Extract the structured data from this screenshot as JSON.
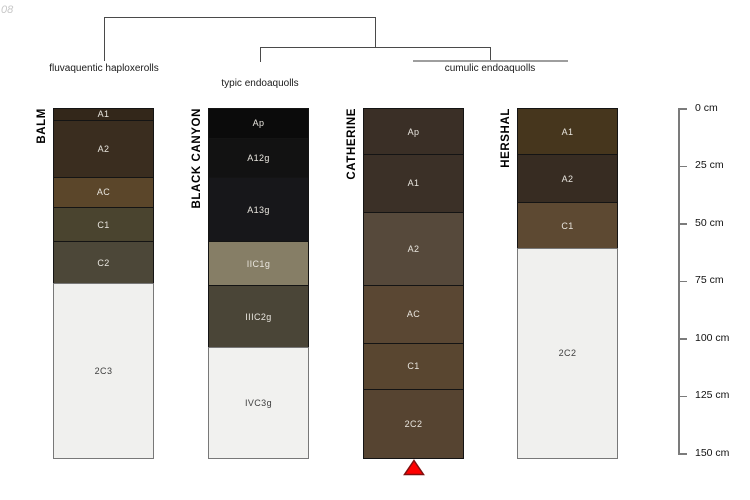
{
  "watermark": "08",
  "dendrogram": {
    "labels": [
      "fluvaquentic haploxerolls",
      "typic endoaquolls",
      "cumulic endoaquolls"
    ]
  },
  "chart_data": {
    "type": "bar",
    "variant": "soil-profile-depth-columns-with-dendrogram",
    "depth_axis": {
      "unit": "cm",
      "range": [
        0,
        152
      ],
      "ticks": [
        0,
        25,
        50,
        75,
        100,
        125,
        150
      ],
      "tick_labels": [
        "0 cm",
        "25 cm",
        "50 cm",
        "75 cm",
        "100 cm",
        "125 cm",
        "150 cm"
      ]
    },
    "groups": [
      {
        "name": "fluvaquentic haploxerolls",
        "profiles": [
          "BALM"
        ]
      },
      {
        "name": "typic endoaquolls",
        "profiles": [
          "BLACK CANYON"
        ]
      },
      {
        "name": "cumulic endoaquolls",
        "profiles": [
          "CATHERINE",
          "HERSHAL"
        ]
      }
    ],
    "marker_color": "#ff0000",
    "profiles": [
      {
        "name": "BALM",
        "marker": false,
        "layers": [
          {
            "horizon": "A1",
            "top_cm": 0,
            "bottom_cm": 5,
            "color": "#33271a"
          },
          {
            "horizon": "A2",
            "top_cm": 5,
            "bottom_cm": 30,
            "color": "#3a2d1f"
          },
          {
            "horizon": "AC",
            "top_cm": 30,
            "bottom_cm": 43,
            "color": "#5b462a"
          },
          {
            "horizon": "C1",
            "top_cm": 43,
            "bottom_cm": 58,
            "color": "#4a442f"
          },
          {
            "horizon": "C2",
            "top_cm": 58,
            "bottom_cm": 76,
            "color": "#4c4738"
          },
          {
            "horizon": "2C3",
            "top_cm": 76,
            "bottom_cm": 152,
            "color": "#f0f0ee"
          }
        ]
      },
      {
        "name": "BLACK CANYON",
        "marker": false,
        "layers": [
          {
            "horizon": "Ap",
            "top_cm": 0,
            "bottom_cm": 13,
            "color": "#0b0b0b"
          },
          {
            "horizon": "A12g",
            "top_cm": 13,
            "bottom_cm": 30,
            "color": "#121212"
          },
          {
            "horizon": "A13g",
            "top_cm": 30,
            "bottom_cm": 58,
            "color": "#17171a"
          },
          {
            "horizon": "IIC1g",
            "top_cm": 58,
            "bottom_cm": 77,
            "color": "#867e66"
          },
          {
            "horizon": "IIIC2g",
            "top_cm": 77,
            "bottom_cm": 104,
            "color": "#4a4537"
          },
          {
            "horizon": "IVC3g",
            "top_cm": 104,
            "bottom_cm": 152,
            "color": "#f1f1ef"
          }
        ]
      },
      {
        "name": "CATHERINE",
        "marker": true,
        "layers": [
          {
            "horizon": "Ap",
            "top_cm": 0,
            "bottom_cm": 20,
            "color": "#3a2f26"
          },
          {
            "horizon": "A1",
            "top_cm": 20,
            "bottom_cm": 45,
            "color": "#3b3027"
          },
          {
            "horizon": "A2",
            "top_cm": 45,
            "bottom_cm": 77,
            "color": "#56493b"
          },
          {
            "horizon": "AC",
            "top_cm": 77,
            "bottom_cm": 102,
            "color": "#5a4733"
          },
          {
            "horizon": "C1",
            "top_cm": 102,
            "bottom_cm": 122,
            "color": "#594630"
          },
          {
            "horizon": "2C2",
            "top_cm": 122,
            "bottom_cm": 152,
            "color": "#564431"
          }
        ]
      },
      {
        "name": "HERSHAL",
        "marker": false,
        "layers": [
          {
            "horizon": "A1",
            "top_cm": 0,
            "bottom_cm": 20,
            "color": "#46361d"
          },
          {
            "horizon": "A2",
            "top_cm": 20,
            "bottom_cm": 41,
            "color": "#372c22"
          },
          {
            "horizon": "C1",
            "top_cm": 41,
            "bottom_cm": 61,
            "color": "#5d4932"
          },
          {
            "horizon": "2C2",
            "top_cm": 61,
            "bottom_cm": 152,
            "color": "#f0f0ee"
          }
        ]
      }
    ]
  }
}
